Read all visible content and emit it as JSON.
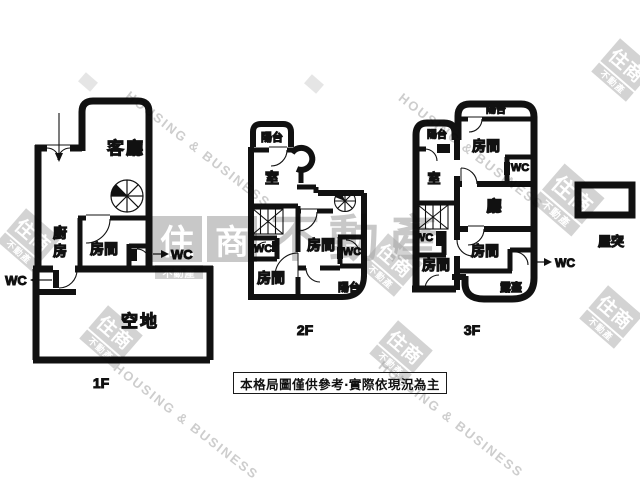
{
  "page": {
    "ink": "#111111",
    "background": "#ffffff",
    "watermark_gray": "#a7a7a7"
  },
  "floor1": {
    "label": "1F",
    "living_room": "客廳",
    "kitchen_char1": "廚",
    "kitchen_char2": "房",
    "bedroom": "房間",
    "wc_inner": "WC",
    "wc_outer": "WC",
    "yard": "空地"
  },
  "floor2": {
    "label": "2F",
    "balcony_top": "陽台",
    "room": "室",
    "wc_left": "WC",
    "wc_right": "WC",
    "bedroom_mid": "房間",
    "bedroom_bottom": "房間",
    "balcony_bottom": "陽台"
  },
  "floor3": {
    "label": "3F",
    "balcony_top": "陽台",
    "balcony_left": "陽台",
    "bedroom_top": "房間",
    "wc_top": "WC",
    "room": "室",
    "hall": "廳",
    "wc_left": "WC",
    "bedroom_mid": "房間",
    "bedroom_bottom": "房間",
    "terrace": "露臺",
    "wc_out": "WC"
  },
  "roof": {
    "label": "屋突"
  },
  "disclaimer": {
    "text": "本格局圖僅供參考‧實際依現況為主"
  },
  "watermark": {
    "brand_cn": "住商不動產",
    "brand_en": "HOUSING & BUSINESS",
    "logo_main": "住商",
    "logo_char1": "住",
    "logo_char2": "商",
    "logo_sub": "不動產"
  }
}
